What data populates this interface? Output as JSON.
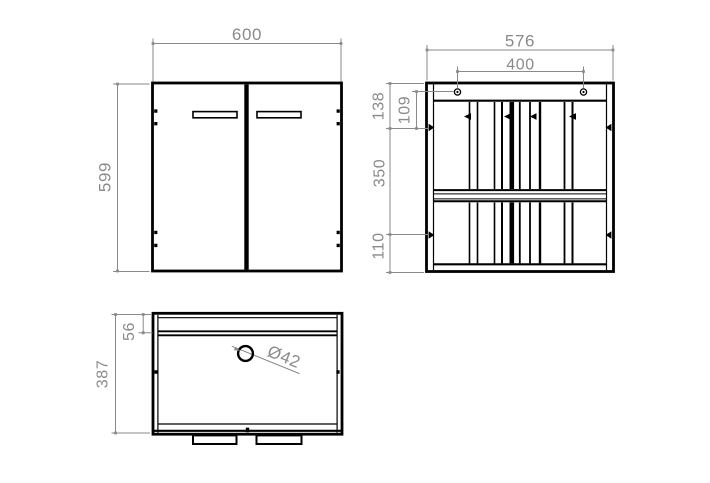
{
  "colors": {
    "background": "#ffffff",
    "line": "#000000",
    "dimension": "#8a8a8a"
  },
  "views": {
    "front": {
      "width": "600",
      "height": "599"
    },
    "back": {
      "width": "576",
      "hole_span": "400",
      "top_to_cam": "138",
      "hole_to_cam": "109",
      "cam_span": "350",
      "bottom_to_cam": "110"
    },
    "top": {
      "depth": "387",
      "back_rail_depth": "56",
      "hole_diameter": "Ø42"
    }
  }
}
